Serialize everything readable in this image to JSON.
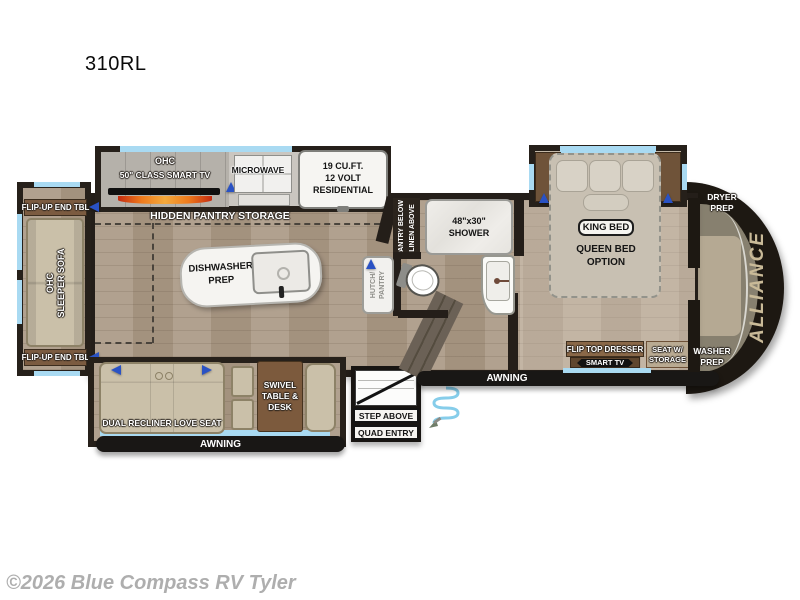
{
  "title": "310RL",
  "copyright": "©2026 Blue Compass RV Tyler",
  "brand": "ALLIANCE",
  "colors": {
    "floor": "#ab9a87",
    "wall": "#241e19",
    "window_blue": "#a9daf2",
    "furniture_beige": "#cac0a9",
    "furniture_wood": "#7b5b40",
    "awning_black": "#191715",
    "arrow_blue": "#2a52c4",
    "brand_gold": "#c9ba98"
  },
  "living_area": {
    "ohc": "OHC",
    "class_tv": "50\" CLASS SMART TV",
    "hidden_pantry": "HIDDEN PANTRY STORAGE",
    "flip_up_end_tbl": "FLIP-UP END TBL",
    "sofa_ohc": "OHC",
    "sleeper_sofa": "SLEEPER SOFA",
    "dual_recliner": "DUAL RECLINER LOVE SEAT",
    "swivel_line1": "SWIVEL",
    "swivel_line2": "TABLE &",
    "swivel_line3": "DESK",
    "awning": "AWNING"
  },
  "kitchen": {
    "microwave": "MICROWAVE",
    "fridge_line1": "19 CU.FT.",
    "fridge_line2": "12 VOLT",
    "fridge_line3": "RESIDENTIAL",
    "island_line1": "DISHWASHER",
    "island_line2": "PREP",
    "hutch_line1": "HUTCH/",
    "hutch_line2": "PANTRY"
  },
  "bathroom": {
    "pantry_below": "PANTRY BELOW",
    "linen_above": "LINEN ABOVE",
    "shower_size": "48\"x30\"",
    "shower": "SHOWER"
  },
  "bedroom": {
    "king_bed": "KING BED",
    "queen_line1": "QUEEN BED",
    "queen_line2": "OPTION",
    "flip_top_dresser": "FLIP TOP DRESSER",
    "smart_tv": "SMART TV",
    "seat_line1": "SEAT W/",
    "seat_line2": "STORAGE"
  },
  "utility": {
    "dryer_line1": "DRYER",
    "dryer_line2": "PREP",
    "washer_line1": "WASHER",
    "washer_line2": "PREP"
  },
  "entry": {
    "awning": "AWNING",
    "step_above": "STEP ABOVE",
    "quad_entry": "QUAD ENTRY"
  }
}
